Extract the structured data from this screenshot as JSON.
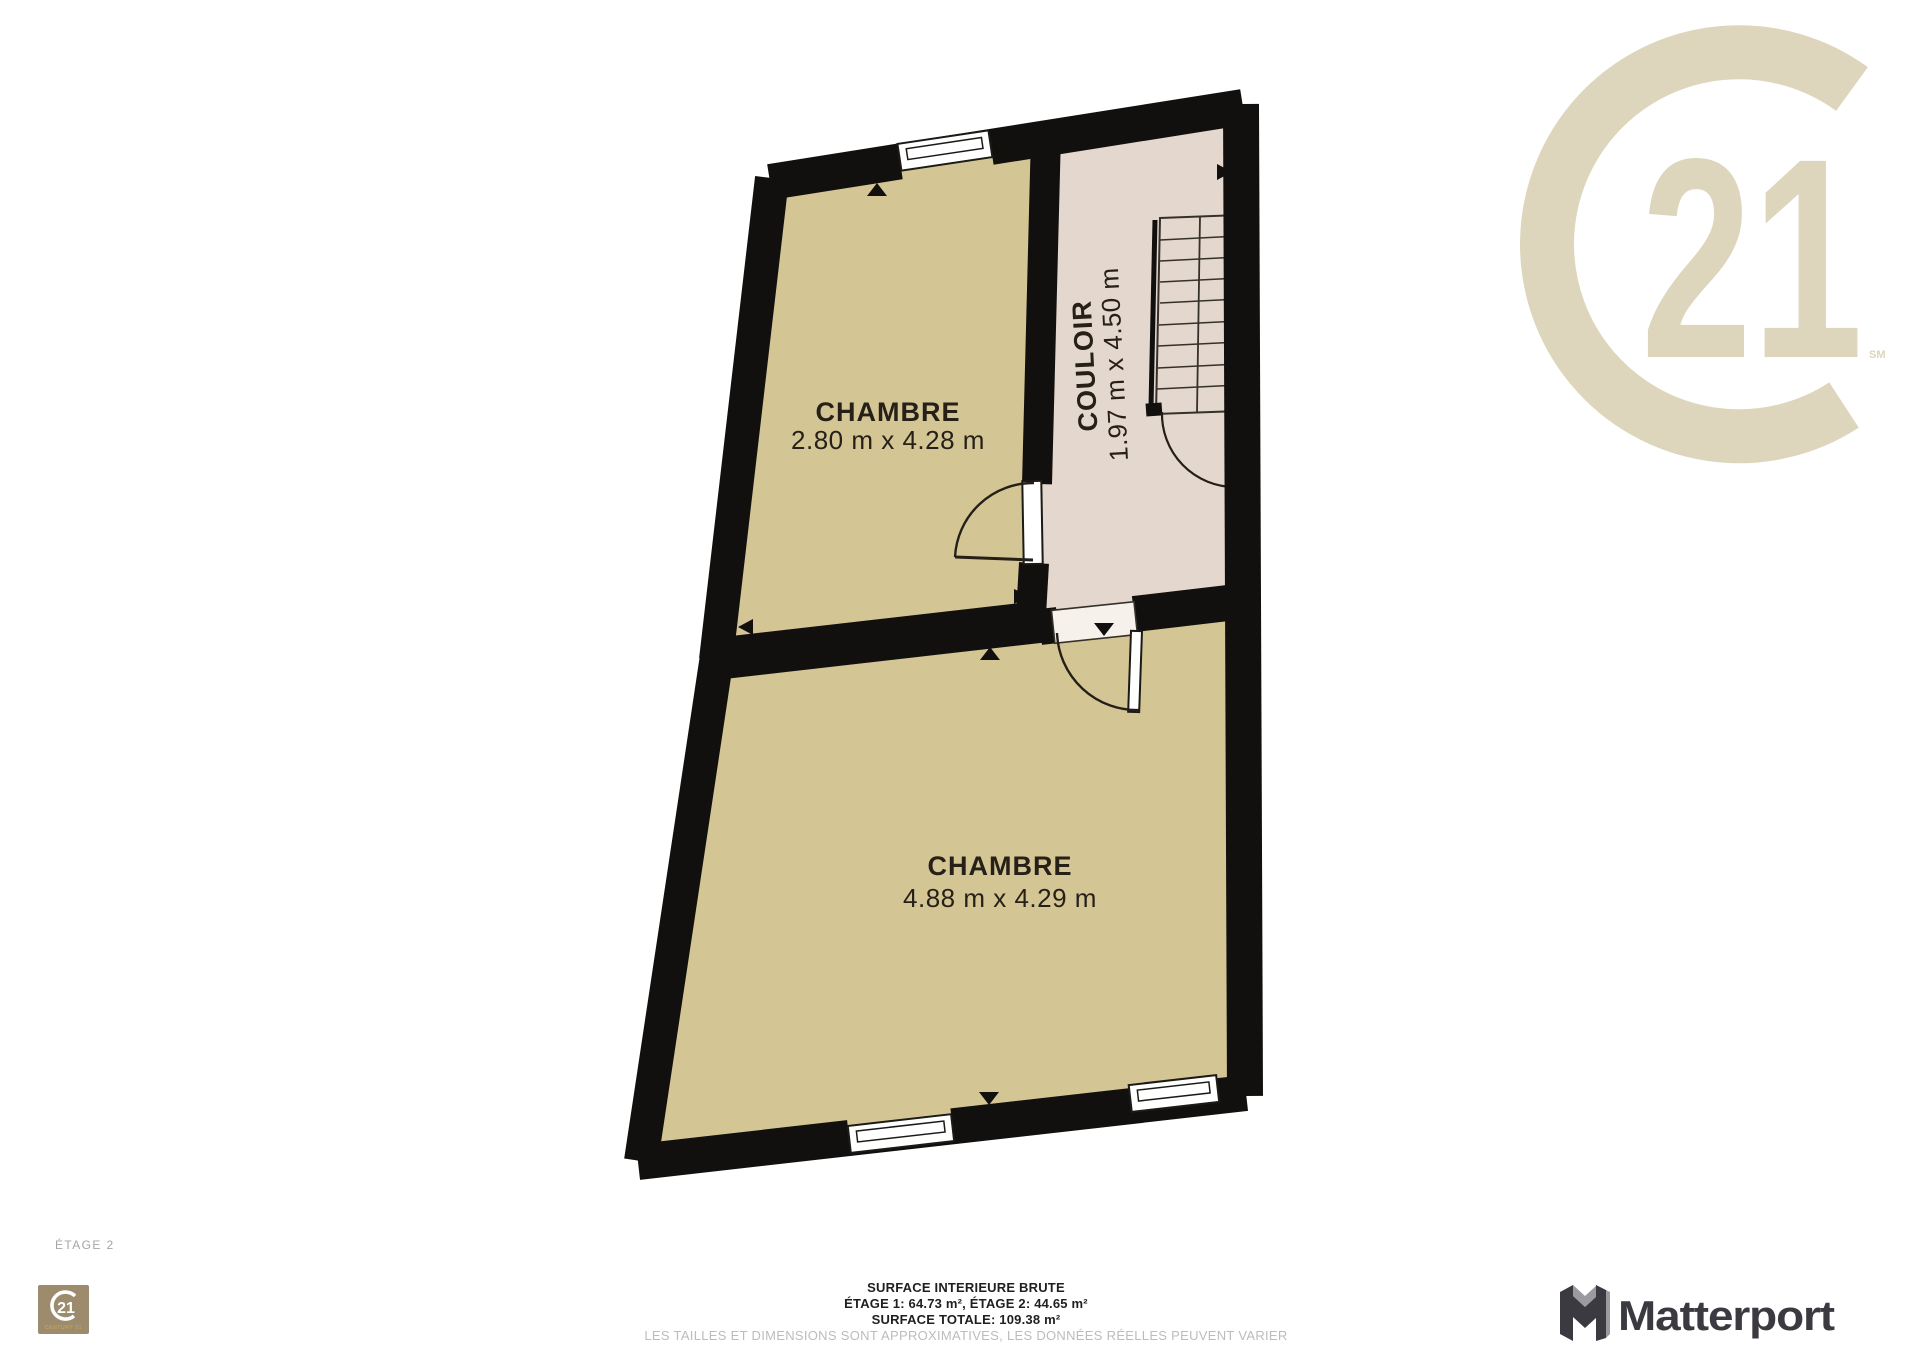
{
  "plan": {
    "floor_label": "ÉTAGE 2",
    "rooms": [
      {
        "name": "CHAMBRE",
        "dimensions": "2.80 m x 4.28 m"
      },
      {
        "name": "COULOIR",
        "dimensions": "1.97 m x 4.50 m"
      },
      {
        "name": "CHAMBRE",
        "dimensions": "4.88 m x 4.29 m"
      }
    ]
  },
  "footer": {
    "title": "SURFACE INTERIEURE BRUTE",
    "floors": "ÉTAGE 1: 64.73 m², ÉTAGE 2: 44.65 m²",
    "total": "SURFACE TOTALE: 109.38 m²",
    "disclaimer": "LES TAILLES ET DIMENSIONS SONT APPROXIMATIVES, LES DONNÉES RÉELLES PEUVENT VARIER"
  },
  "branding": {
    "century21_watermark": {
      "number": "21",
      "service_mark": "SM"
    },
    "century21_badge": {
      "number": "21",
      "wordmark": "CENTURY 21"
    },
    "matterport": {
      "wordmark": "Matterport"
    }
  },
  "colors": {
    "room_fill": "#d4c694",
    "hallway_fill": "#e4d7cd",
    "wall": "#12100e",
    "watermark_beige": "#ddd6bc",
    "badge_background": "#9d8b6e",
    "badge_gold_text": "#d9a93c",
    "matterport_dark": "#3a3a40",
    "matterport_light": "#9b9aa0",
    "footer_text": "#1f1f1f",
    "muted_text": "#bcbcbc"
  }
}
